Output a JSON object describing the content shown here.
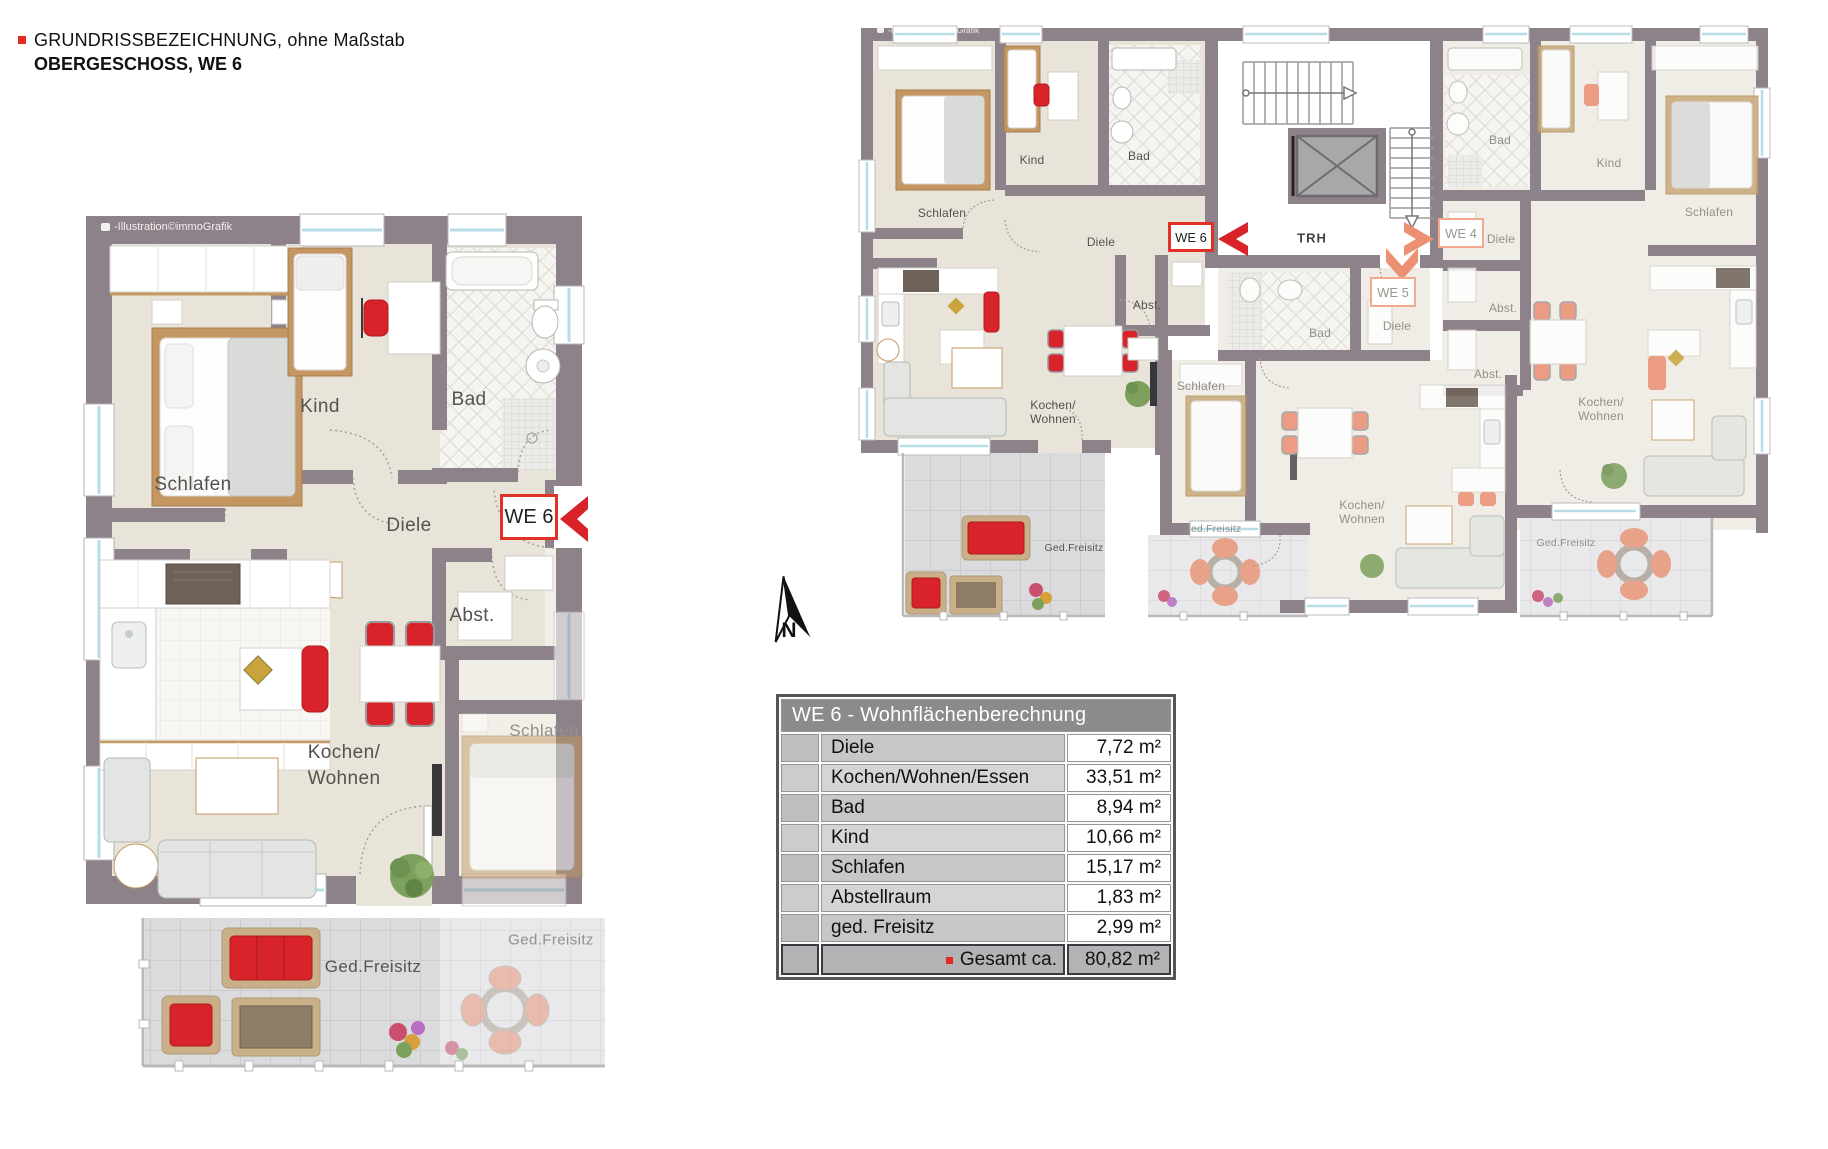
{
  "header": {
    "line1": "GRUNDRISSBEZEICHNUNG, ohne Maßstab",
    "line2": "OBERGESCHOSS, WE 6"
  },
  "watermark": {
    "text": "-Illustration©immoGrafik"
  },
  "north_label": "N",
  "colors": {
    "accent_red": "#d8232a",
    "accent_salmon": "#ec8f72"
  },
  "detail_plan": {
    "unit_tag": "WE 6",
    "rooms": {
      "schlafen": "Schlafen",
      "kind": "Kind",
      "bad": "Bad",
      "diele": "Diele",
      "abst": "Abst.",
      "kochen": "Kochen/",
      "wohnen": "Wohnen",
      "freisitz": "Ged.Freisitz"
    },
    "neighbor": {
      "schlafen": "Schlafen",
      "freisitz": "Ged.Freisitz"
    }
  },
  "overview_plan": {
    "trh": "TRH",
    "we6": {
      "tag": "WE 6",
      "schlafen": "Schlafen",
      "kind": "Kind",
      "bad": "Bad",
      "diele": "Diele",
      "abst": "Abst.",
      "kochen": "Kochen/",
      "wohnen": "Wohnen",
      "freisitz": "Ged.Freisitz"
    },
    "we4": {
      "tag": "WE 4",
      "bad": "Bad",
      "kind": "Kind",
      "schlafen": "Schlafen",
      "diele": "Diele",
      "abst1": "Abst.",
      "abst2": "Abst.",
      "kochen": "Kochen/",
      "wohnen": "Wohnen",
      "freisitz": "Ged.Freisitz"
    },
    "we5": {
      "tag": "WE 5",
      "bad": "Bad",
      "diele": "Diele",
      "schlafen": "Schlafen",
      "kochen": "Kochen/",
      "wohnen": "Wohnen",
      "freisitz": "Ged.Freisitz"
    }
  },
  "area_table": {
    "title": "WE 6 - Wohnflächenberechnung",
    "rows": [
      {
        "label": "Diele",
        "value": "7,72 m²"
      },
      {
        "label": "Kochen/Wohnen/Essen",
        "value": "33,51 m²"
      },
      {
        "label": "Bad",
        "value": "8,94 m²"
      },
      {
        "label": "Kind",
        "value": "10,66 m²"
      },
      {
        "label": "Schlafen",
        "value": "15,17 m²"
      },
      {
        "label": "Abstellraum",
        "value": "1,83 m²"
      },
      {
        "label": "ged. Freisitz",
        "value": "2,99 m²"
      }
    ],
    "total_label": "Gesamt ca.",
    "total_value": "80,82 m²"
  }
}
